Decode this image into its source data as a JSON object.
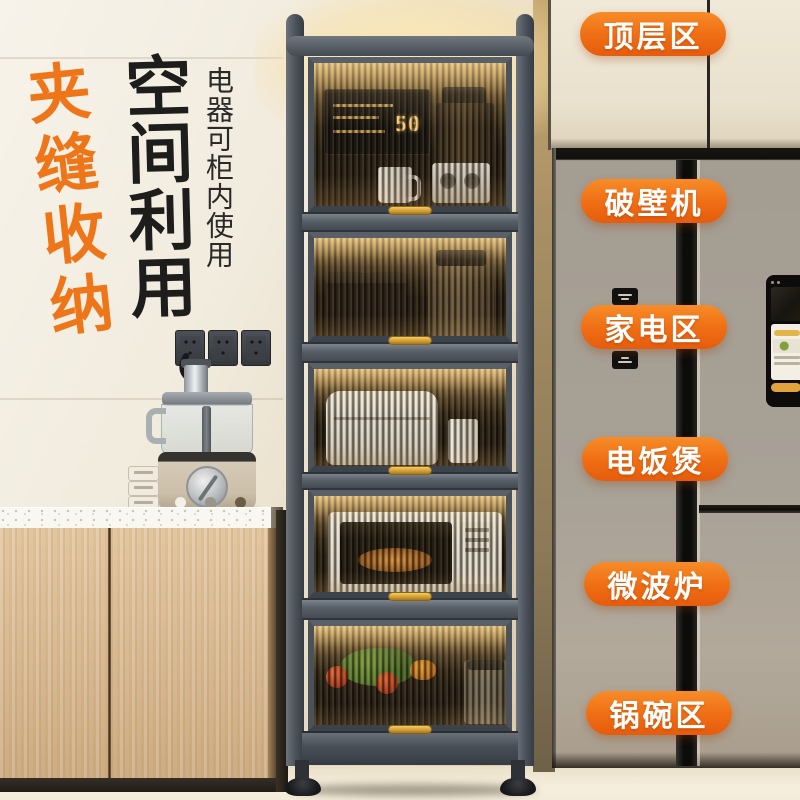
{
  "page": {
    "title": "夹缝收纳厨房置物柜产品图"
  },
  "headline": {
    "primary": "夹缝收纳",
    "secondary": "空间利用",
    "note": "电器可柜内使用"
  },
  "zone_labels": [
    {
      "text": "顶层区"
    },
    {
      "text": "破壁机"
    },
    {
      "text": "家电区"
    },
    {
      "text": "电饭煲"
    },
    {
      "text": "微波炉"
    },
    {
      "text": "锅碗区"
    }
  ],
  "cabinet": {
    "display_value": "50"
  },
  "colors": {
    "accent_orange": "#ef6d14",
    "headline_orange": "#ee7518",
    "headline_black": "#1d1d1b",
    "shelf_gray": "#4c525a",
    "handle_gold": "#d7a33c",
    "glass_amber": "#a87f42",
    "wood": "#d9b98f",
    "wall_cream": "#efe9dc",
    "fridge_gray": "#a49e94"
  }
}
